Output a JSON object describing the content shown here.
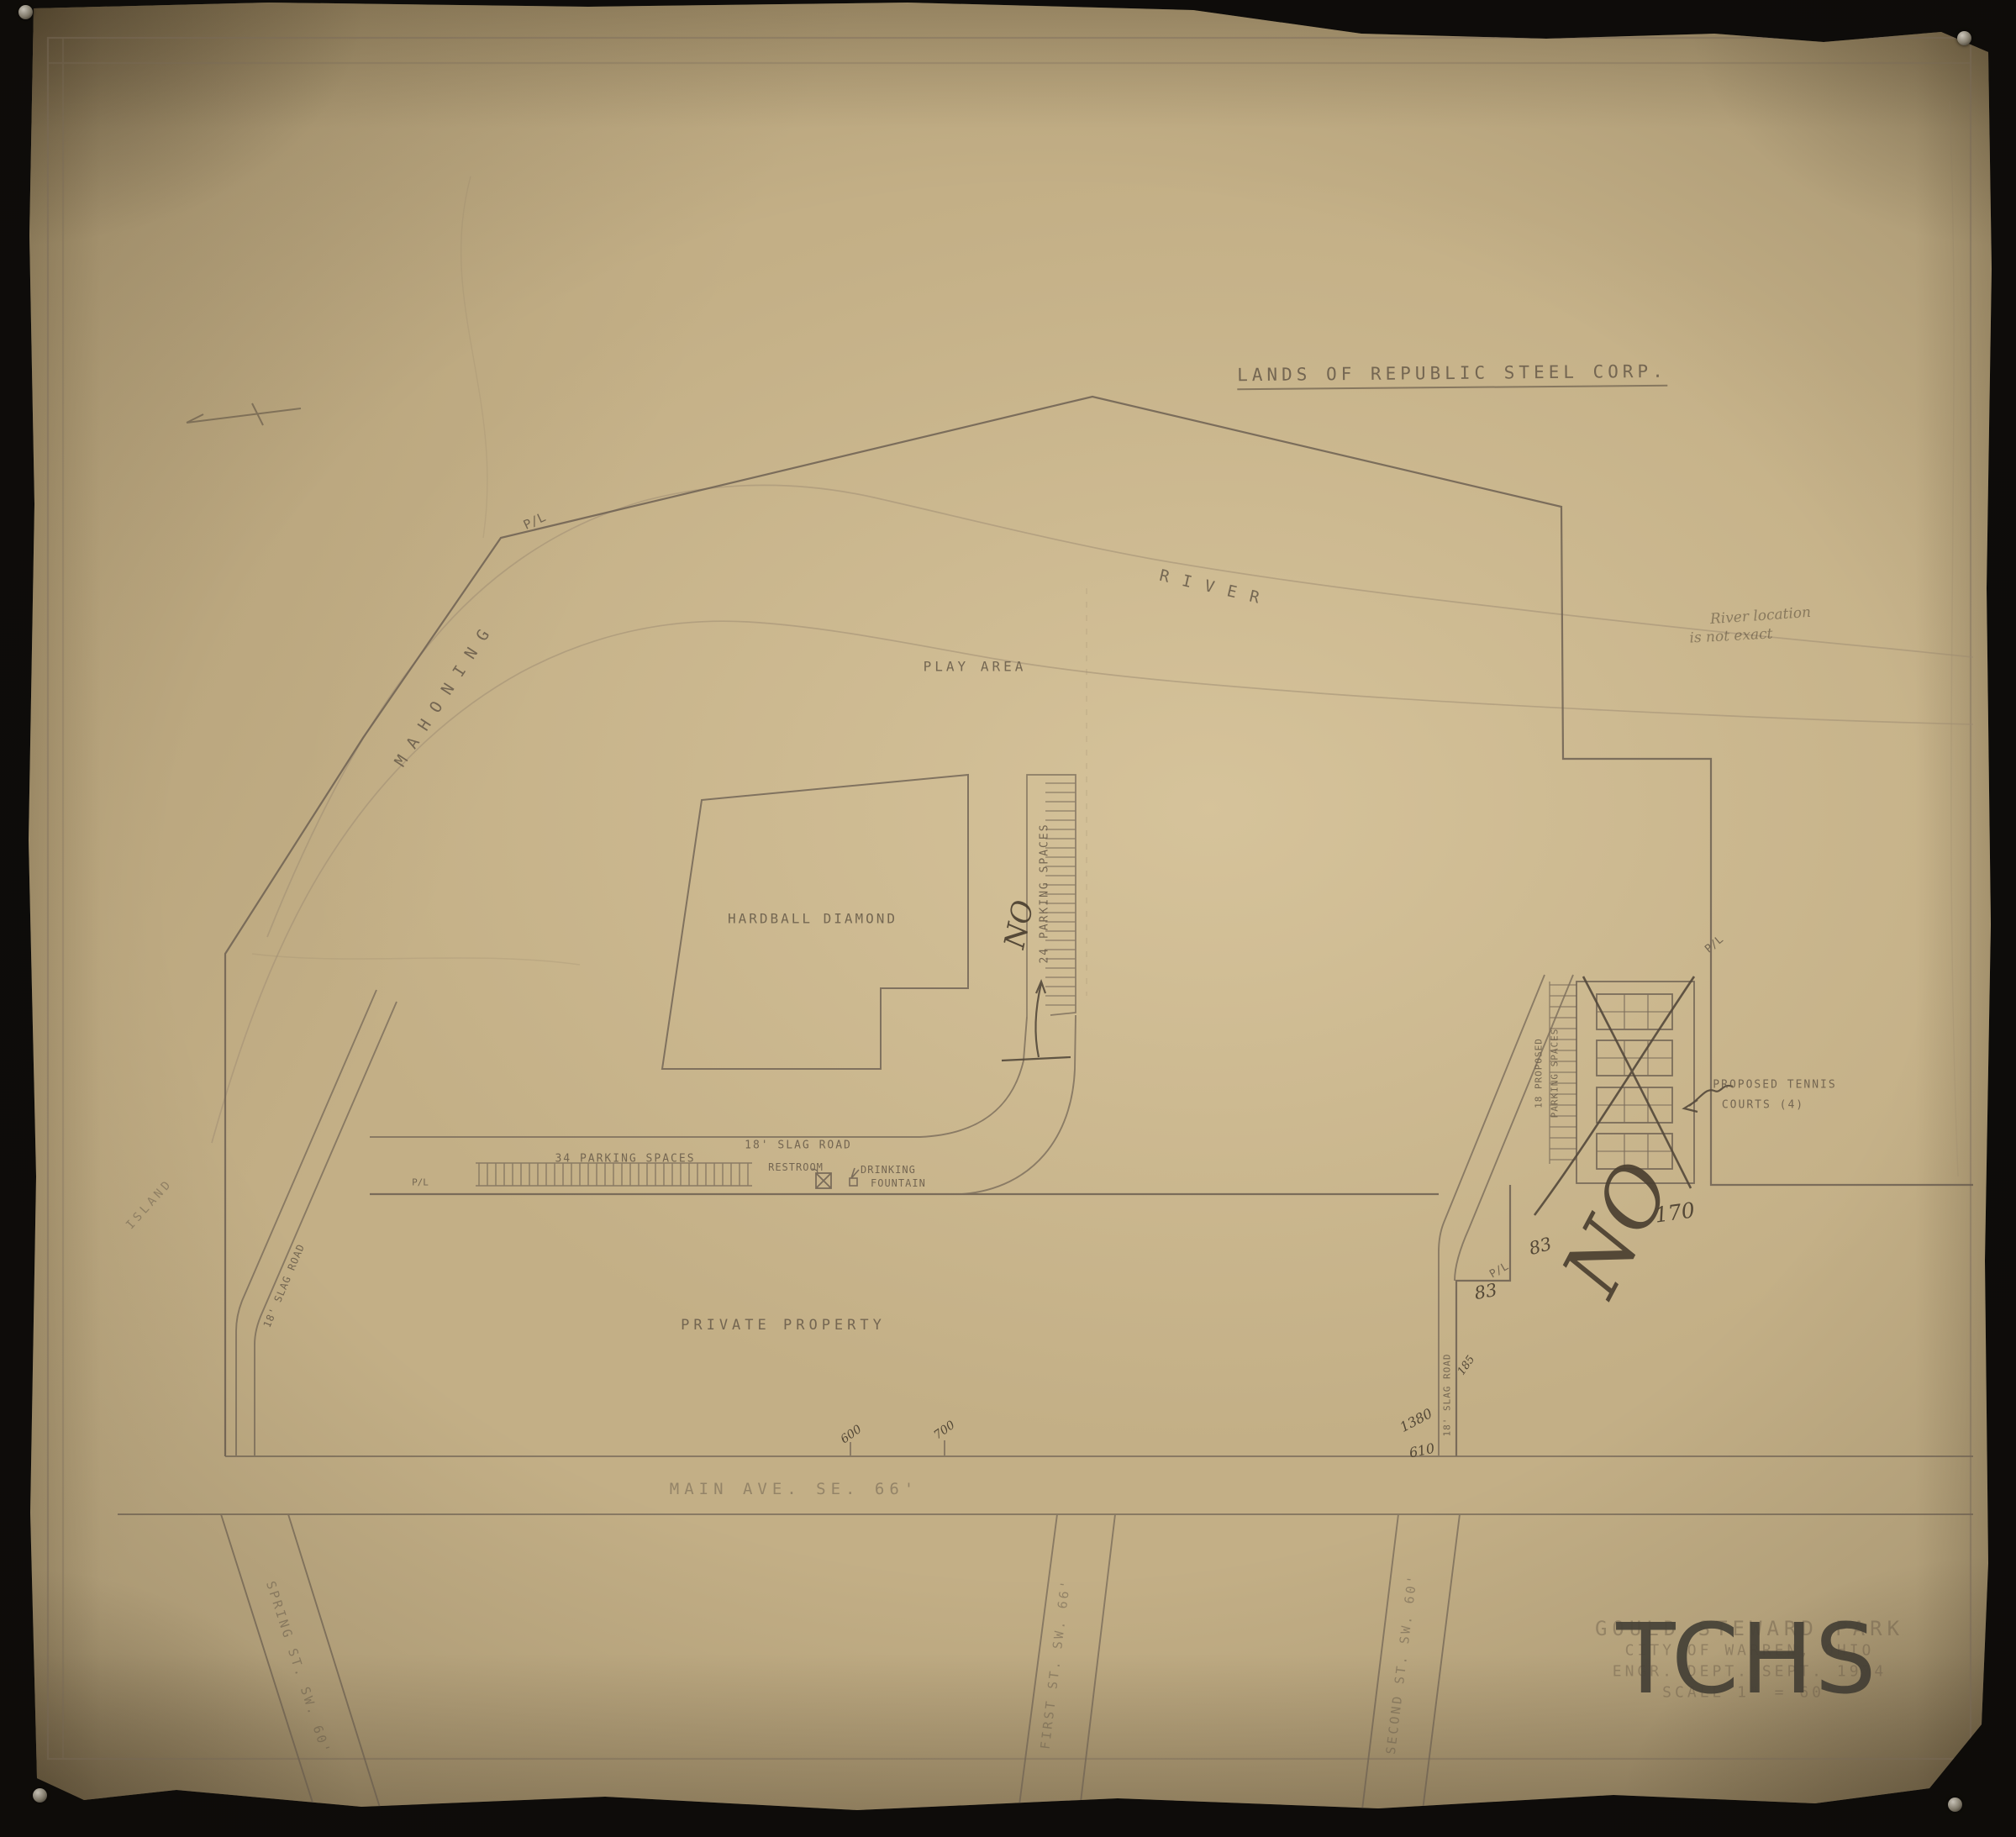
{
  "photo": {
    "background_color": "#0d0c0a",
    "paper_color": "#c3af86",
    "ink_color": "#6c5f4d",
    "watermark": "TCHS"
  },
  "title_block": {
    "line1": "GOULD STEWARD PARK",
    "line2": "CITY OF WARREN, OHIO",
    "line3": "ENGR. DEPT.   SEPT. 1974",
    "line4": "SCALE 1\" = 60'"
  },
  "map": {
    "lands_label": "LANDS OF REPUBLIC STEEL CORP.",
    "river": {
      "word1": "MAHONING",
      "word2": "RIVER"
    },
    "river_note": {
      "line1": "River location",
      "line2": "is not exact"
    },
    "areas": {
      "play_area": "PLAY AREA",
      "hardball": "HARDBALL DIAMOND",
      "private_property": "PRIVATE PROPERTY",
      "island": "ISLAND"
    },
    "parking": {
      "p24": "24 PARKING SPACES",
      "p34": "34 PARKING SPACES",
      "proposed_line1": "18 PROPOSED",
      "proposed_line2": "PARKING SPACES"
    },
    "roads": {
      "slag_center": "18' SLAG ROAD",
      "slag_left": "18' SLAG ROAD",
      "slag_right": "18' SLAG ROAD",
      "main_ave": "MAIN AVE. SE. 66'",
      "spring_st": "SPRING ST. SW. 60'",
      "first_st": "FIRST ST. SW. 66'",
      "second_st": "SECOND ST. SW. 60'"
    },
    "facilities": {
      "restroom": "RESTROOM",
      "drinking_line1": "DRINKING",
      "drinking_line2": "FOUNTAIN",
      "tennis_line1": "PROPOSED TENNIS",
      "tennis_line2": "COURTS (4)"
    },
    "property_marks": {
      "pl": "P/L"
    },
    "handwritten": {
      "no_parking": "NO",
      "no_tennis": "NO",
      "dim170": "170",
      "dim83a": "83",
      "dim83b": "83",
      "sta600": "600",
      "sta700": "700",
      "scrib1380": "1380",
      "scrib610": "610",
      "scrib185": "185"
    }
  }
}
